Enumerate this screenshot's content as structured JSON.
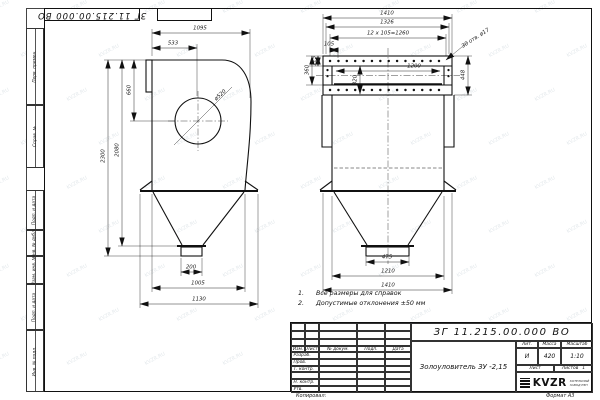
{
  "watermark": {
    "text": "KVZR.RU"
  },
  "frame": {
    "top_stamp": "ЗГ 11.215.00.000 ВО",
    "left_labels": [
      "Перв. примен.",
      "Справ. №",
      "Подп. и дата",
      "Инв. № дубл.",
      "Взам. инв. №",
      "Подп. и дата",
      "Инв. № подл."
    ],
    "copied_label": "Копировал:",
    "format_label": "Формат А3"
  },
  "notes": {
    "items": [
      {
        "num": "1.",
        "text": "Все размеры для справок"
      },
      {
        "num": "2.",
        "text": "Допустимые отклонения  ±50 мм"
      }
    ]
  },
  "title_block": {
    "doc_number": "ЗГ 11.215.00.000  ВО",
    "part_name": "Золоуловитель  ЗУ -2,15",
    "headers": {
      "lit": "Лит.",
      "mass": "Масса",
      "scale": "Масштаб"
    },
    "values": {
      "lit": "И",
      "mass": "420",
      "scale": "1:10"
    },
    "sheet_label": "Лист",
    "sheets_label": "Листов",
    "sheets_value": "1",
    "change_cols": [
      "Изм.",
      "Лист",
      "№ докум.",
      "Подп.",
      "Дата"
    ],
    "sign_rows": [
      "Разраб.",
      "Пров.",
      "Т. контр.",
      "",
      "Н. контр.",
      "Утв."
    ],
    "logo_text": "KVZR",
    "logo_sub1": "КОТЕЛЬНЫЙ",
    "logo_sub2": "ЗАВОД РЭП"
  },
  "side_view": {
    "width_top": "1095",
    "inlet_width": "533",
    "inlet_height": "660",
    "circle_dia": "ø520",
    "height_total": "2300",
    "height_inner": "2080",
    "outlet_width": "200",
    "hopper_width": "1005",
    "base_width": "1130"
  },
  "front_view": {
    "width_total": "1410",
    "flange_width": "1326",
    "holes_spacing": "12 х 105=1260",
    "hole_pitch": "105",
    "holes_note": "30 отв. ø17",
    "opening_width": "1200",
    "opening_height": "320",
    "rail_height": "115",
    "mid_height": "360",
    "flange_height": "448",
    "outlet_width": "475",
    "body_width": "1210",
    "base_width": "1410"
  }
}
